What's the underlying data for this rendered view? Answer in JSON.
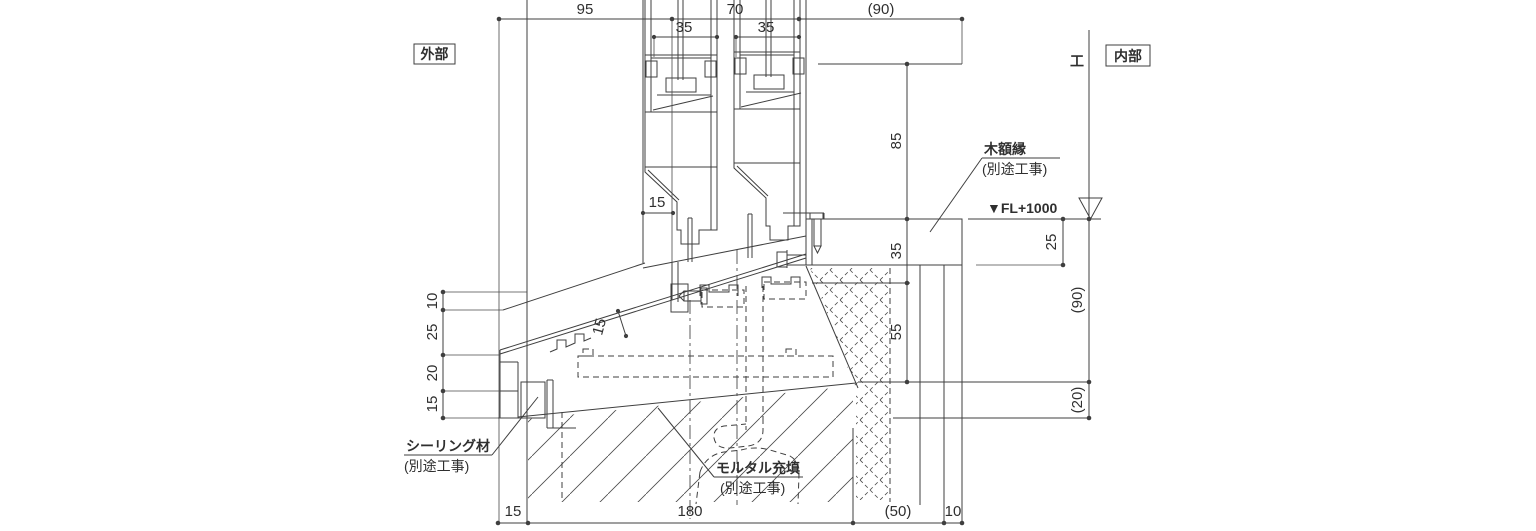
{
  "drawing": {
    "type": "window-sill-section-detail",
    "colors": {
      "line": "#3f3f3f",
      "background": "#ffffff",
      "text": "#2f2f2f"
    }
  },
  "labels": {
    "exterior": "外部",
    "interior": "内部",
    "kanji_right": "工"
  },
  "fl": {
    "text": "▼FL+1000"
  },
  "callouts": {
    "wood": {
      "title": "木額縁",
      "sub": "(別途工事)"
    },
    "sealing": {
      "title": "シーリング材",
      "sub": "(別途工事)"
    },
    "mortar": {
      "title": "モルタル充填",
      "sub": "(別途工事)"
    }
  },
  "dims": {
    "top": {
      "d1": "95",
      "d2": "70",
      "d3": "(90)"
    },
    "sash": {
      "d1": "35",
      "d2": "35"
    },
    "gap": "15",
    "slope": "15",
    "left": {
      "d1": "10",
      "d2": "25",
      "d3": "20",
      "d4": "15"
    },
    "right_inner": {
      "d1": "85",
      "d2": "35",
      "d3": "55"
    },
    "fl_offset": "25",
    "right_outer": {
      "d1": "(90)",
      "d2": "(20)"
    },
    "bottom": {
      "d1": "15",
      "d2": "180",
      "d3": "(50)",
      "d4": "10"
    }
  }
}
